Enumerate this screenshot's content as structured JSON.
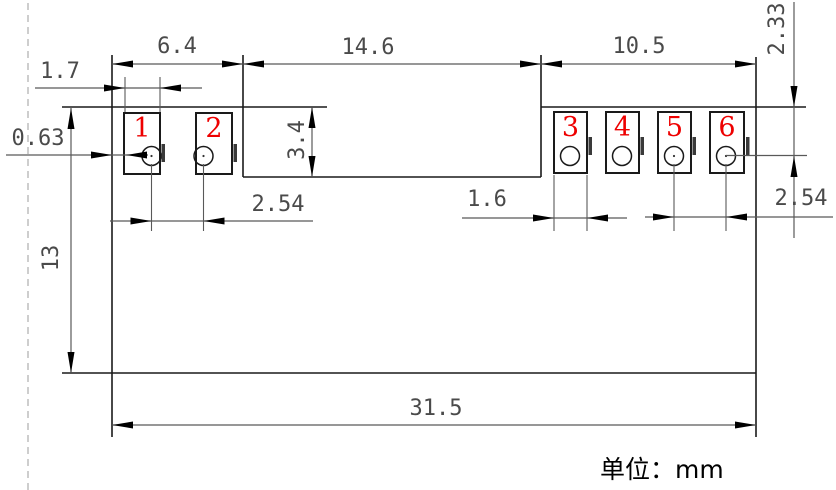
{
  "drawing": {
    "type": "mechanical-dimension-drawing",
    "unit_note": "单位：mm",
    "accent_color": "#ee0000",
    "line_color": "#1a1a1a",
    "dim_color": "#4a4a4a",
    "pads": [
      "1",
      "2",
      "3",
      "4",
      "5",
      "6"
    ],
    "labels": {
      "dim_6_4": "6.4",
      "dim_14_6": "14.6",
      "dim_10_5": "10.5",
      "dim_1_7": "1.7",
      "dim_0_63": "0.63",
      "dim_3_4": "3.4",
      "dim_2_54_left": "2.54",
      "dim_1_6": "1.6",
      "dim_2_54_right": "2.54",
      "dim_2_33": "2.33",
      "dim_13": "13",
      "dim_31_5": "31.5"
    },
    "dimensions_mm": {
      "left_pad_section_width": 6.4,
      "middle_section_width": 14.6,
      "right_pad_section_width": 10.5,
      "left_pad_width": 1.7,
      "edge_to_pad_offset": 0.63,
      "notch_depth": 3.4,
      "left_hole_pitch": 2.54,
      "right_pad_width": 1.6,
      "right_hole_pitch": 2.54,
      "top_edge_to_hole_center": 2.33,
      "body_height": 13,
      "overall_width": 31.5
    }
  }
}
